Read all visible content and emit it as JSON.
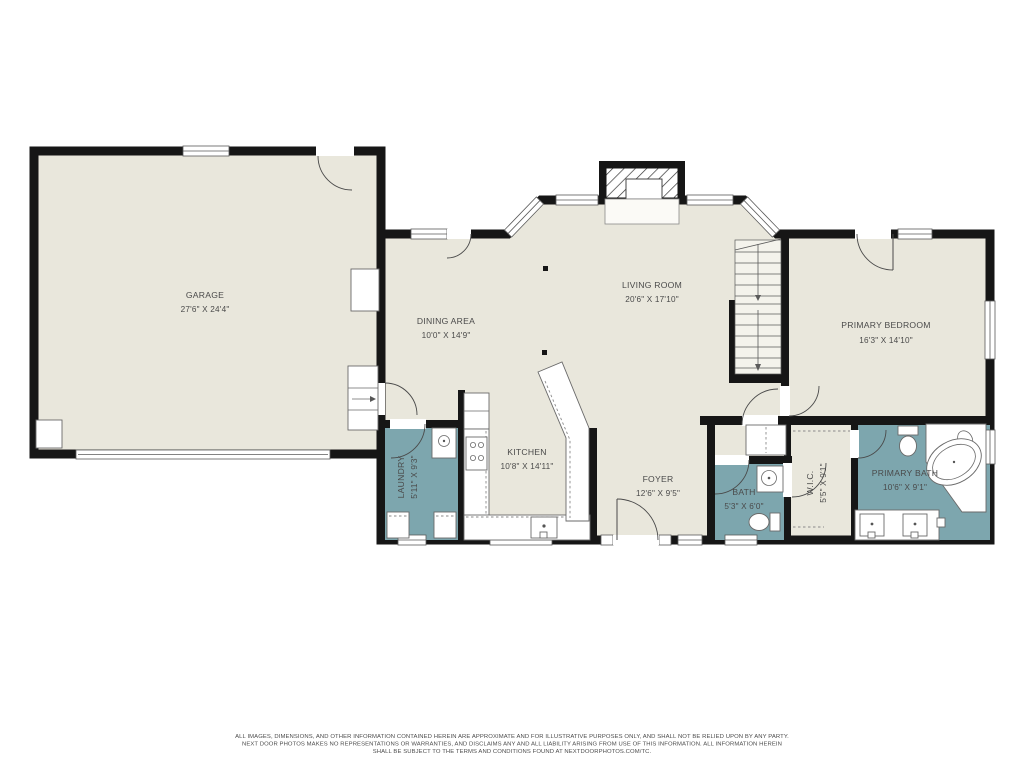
{
  "floorplan": {
    "wall_color": "#161616",
    "floor_color": "#e9e7dc",
    "wet_floor_color": "#7da6ae",
    "label_color": "#4a4a4a",
    "rooms": [
      {
        "id": "garage",
        "name": "GARAGE",
        "dims": "27'6\" X 24'4\""
      },
      {
        "id": "dining-area",
        "name": "DINING AREA",
        "dims": "10'0\" X 14'9\""
      },
      {
        "id": "living-room",
        "name": "LIVING ROOM",
        "dims": "20'6\" X 17'10\""
      },
      {
        "id": "primary-bedroom",
        "name": "PRIMARY BEDROOM",
        "dims": "16'3\" X 14'10\""
      },
      {
        "id": "kitchen",
        "name": "KITCHEN",
        "dims": "10'8\" X 14'11\""
      },
      {
        "id": "laundry",
        "name": "LAUNDRY",
        "dims": "5'11\" X 9'3\""
      },
      {
        "id": "foyer",
        "name": "FOYER",
        "dims": "12'6\" X 9'5\""
      },
      {
        "id": "bath",
        "name": "BATH",
        "dims": "5'3\" X 6'0\""
      },
      {
        "id": "wic",
        "name": "W.I.C.",
        "dims": "5'5\" X 9'1\""
      },
      {
        "id": "primary-bath",
        "name": "PRIMARY BATH",
        "dims": "10'6\" X 9'1\""
      }
    ],
    "disclaimer": {
      "line1": "ALL IMAGES, DIMENSIONS, AND OTHER INFORMATION CONTAINED HEREIN ARE APPROXIMATE AND FOR ILLUSTRATIVE PURPOSES ONLY, AND SHALL NOT BE RELIED UPON BY ANY PARTY.",
      "line2": "NEXT DOOR PHOTOS MAKES NO REPRESENTATIONS OR WARRANTIES, AND DISCLAIMS ANY AND ALL LIABILITY ARISING FROM USE OF THIS INFORMATION. ALL INFORMATION HEREIN",
      "line3": "SHALL BE SUBJECT TO THE TERMS AND CONDITIONS FOUND AT NEXTDOORPHOTOS.COM/TC."
    }
  }
}
